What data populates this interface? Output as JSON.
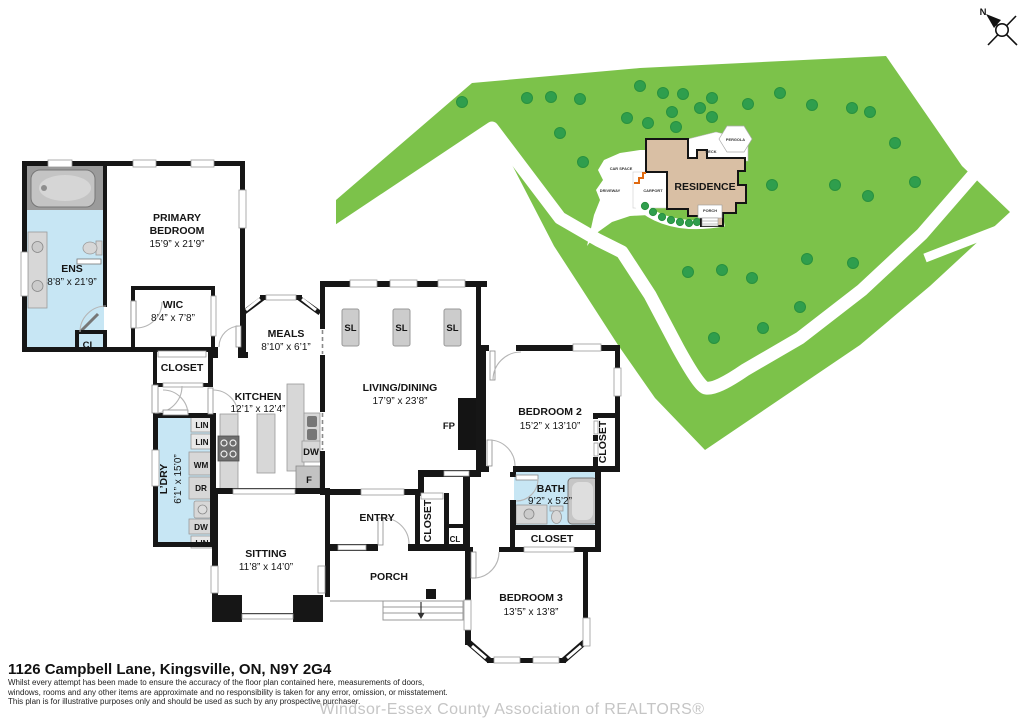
{
  "address": "1126 Campbell Lane, Kingsville, ON, N9Y 2G4",
  "disclaimer": [
    "Whilst every attempt has been made to ensure the accuracy of the floor plan contained here, measurements of doors,",
    "windows, rooms and any other items are approximate and no responsibility is taken for any error, omission, or misstatement.",
    "This plan is for illustrative purposes only and should be used as such by any prospective purchaser."
  ],
  "watermark": "Windsor-Essex County Association of REALTORS®",
  "compass": {
    "north": "N"
  },
  "site": {
    "residence": "RESIDENCE",
    "deck": "DECK",
    "pergola": "PERGOLA",
    "car_space": "CAR SPACE",
    "driveway": "DRIVEWAY",
    "carport": "CARPORT",
    "porch": "PORCH"
  },
  "colors": {
    "lot_green": "#7cc24a",
    "tree_green": "#2f9e4d",
    "residence_tan": "#d9bfa4",
    "bath_blue": "#c7e6f4"
  },
  "rooms": {
    "primary": {
      "name1": "PRIMARY",
      "name2": "BEDROOM",
      "dims": "15’9” x 21’9”"
    },
    "ens": {
      "name": "ENS",
      "dims": "8’8” x 21’9”"
    },
    "wic": {
      "name": "WIC",
      "dims": "8’4” x 7’8”"
    },
    "meals": {
      "name": "MEALS",
      "dims": "8’10” x 6’1”"
    },
    "kitchen": {
      "name": "KITCHEN",
      "dims": "12’1” x 12’4”"
    },
    "living": {
      "name": "LIVING/DINING",
      "dims": "17’9” x 23’8”"
    },
    "ldry": {
      "name": "L’DRY",
      "dims": "6’1” x 15’0”"
    },
    "sitting": {
      "name": "SITTING",
      "dims": "11’8” x 14’0”"
    },
    "entry": {
      "name": "ENTRY"
    },
    "porch": {
      "name": "PORCH"
    },
    "bedroom2": {
      "name": "BEDROOM 2",
      "dims": "15’2” x 13’10”"
    },
    "bath": {
      "name": "BATH",
      "dims": "9’2” x 5’2”"
    },
    "bedroom3": {
      "name": "BEDROOM 3",
      "dims": "13’5” x 13’8”"
    }
  },
  "labels": {
    "closet": "CLOSET",
    "cl": "CL",
    "sl": "SL",
    "fp": "FP",
    "dw": "DW",
    "f": "F",
    "wm": "WM",
    "dr": "DR",
    "lin": "LIN"
  }
}
